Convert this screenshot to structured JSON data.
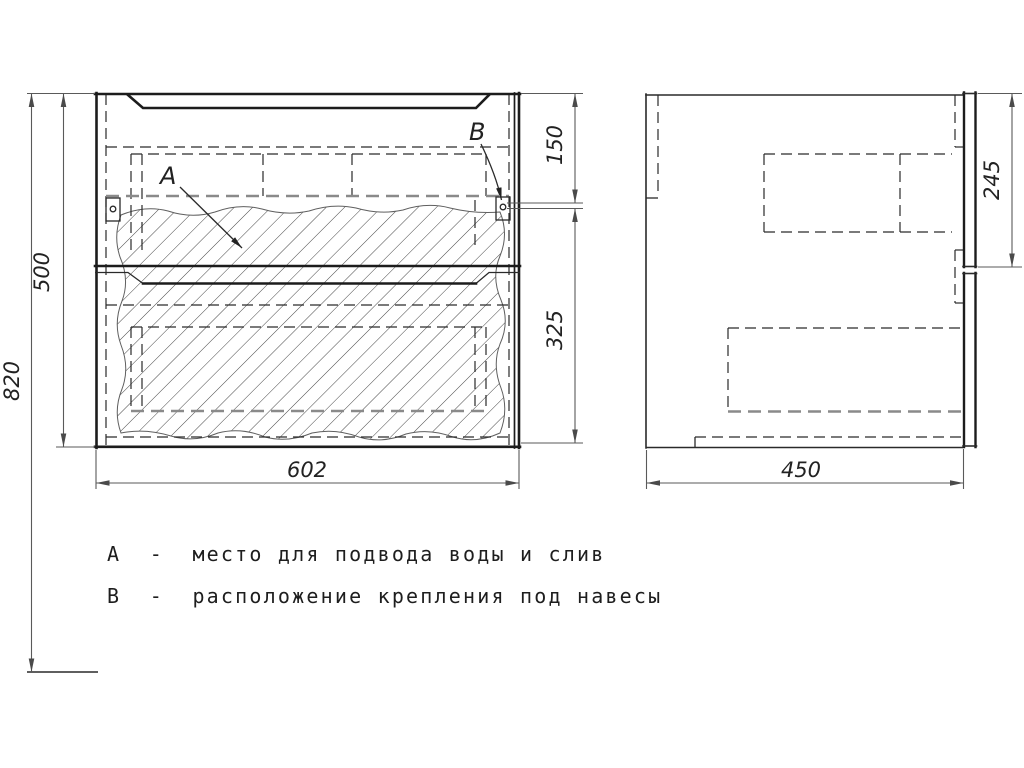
{
  "drawing": {
    "type": "technical-drawing",
    "views": {
      "front": {
        "marker_a": "А",
        "marker_b": "В"
      },
      "side": {}
    },
    "dimensions": {
      "total_height": "820",
      "cabinet_height": "500",
      "top_to_mount": "150",
      "mount_to_bottom": "325",
      "cabinet_width": "602",
      "cabinet_depth": "450",
      "mount_depth": "245"
    },
    "legend": {
      "line_a": "А  -  место для подвода воды и слив",
      "line_b": "В  -  расположение крепления под навесы"
    },
    "colors": {
      "outline": "#1c1c1c",
      "hidden_line": "#2a2a2a",
      "heavy_hidden_line": "#8a8a8a",
      "dimension_line": "#5a5a5a",
      "background": "#ffffff"
    }
  }
}
